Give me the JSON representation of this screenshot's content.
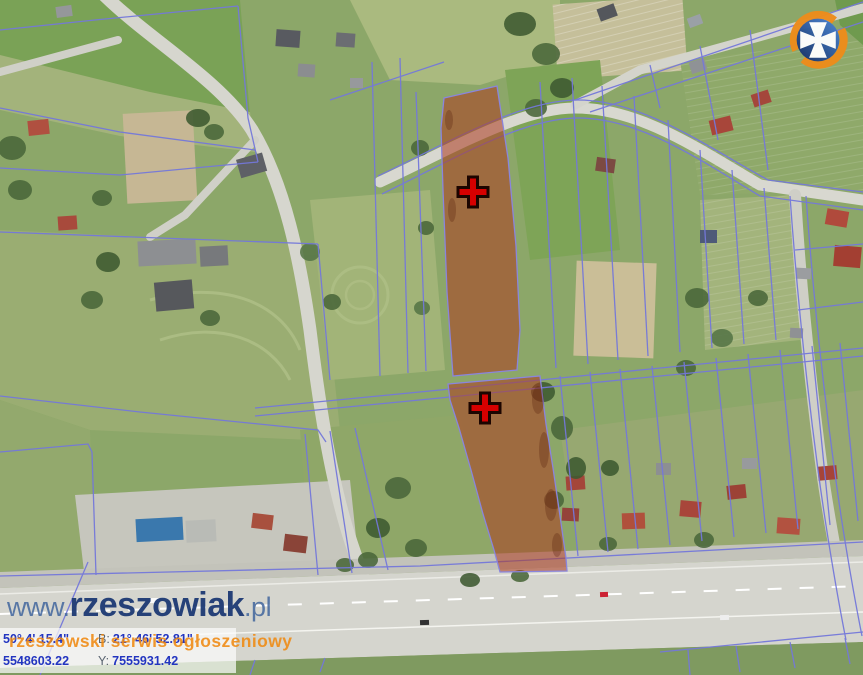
{
  "map": {
    "type": "aerial-cadastral",
    "highlight_color": "#ad3a1f",
    "cadastral_line_color": "#7478da",
    "markers": [
      {
        "name": "upper-parcel-cross",
        "x": 473,
        "y": 192
      },
      {
        "name": "lower-parcel-cross",
        "x": 485,
        "y": 408
      }
    ]
  },
  "watermark": {
    "www": "www.",
    "name": "rzeszowiak",
    "tld": ".pl",
    "tagline": "rzeszowski serwis ogłoszeniowy"
  },
  "logo": {
    "name": "rzeszow-city-crest",
    "cross_color": "#ffffff",
    "disc_color": "#1e4fa0",
    "ring_color": "#ee8c1a"
  },
  "coords": {
    "lat_value": "50° 4' 15.4\"",
    "lon_label": "B:",
    "lon_value": "21° 46' 52.81\"",
    "x_value": "5548603.22",
    "y_label": "Y:",
    "y_value": "7555931.42"
  }
}
